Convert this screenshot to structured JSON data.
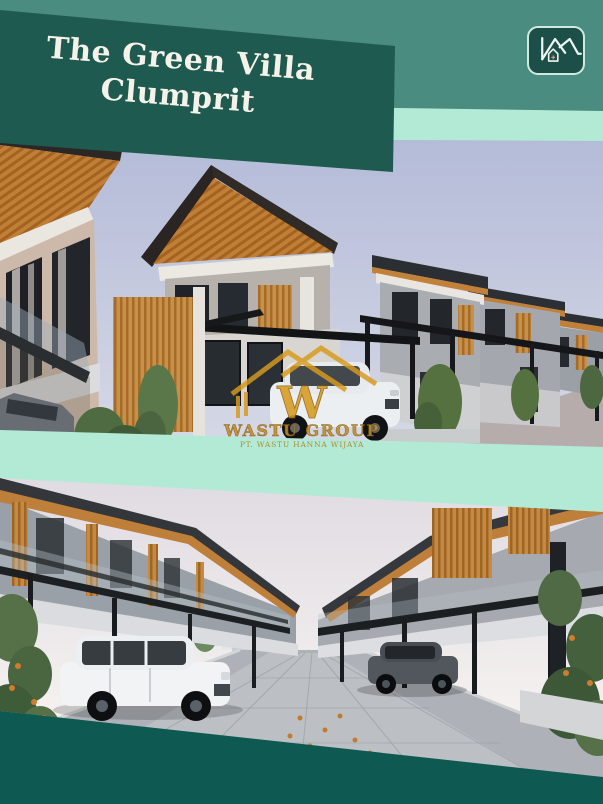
{
  "poster": {
    "banner": {
      "title_line1": "The Green Villa",
      "title_line2": "Clumprit"
    },
    "brand_logo": {
      "icon": "house-roofline-icon"
    },
    "watermark": {
      "logo_letter": "W",
      "brand": "WASTU GROUP",
      "company": "PT. WASTU HANNA WIJAYA"
    },
    "photos": [
      {
        "alt": "Exterior render of a row of modern two-storey villas with dark roofs, orange timber slat accents, black carport pergolas and a white SUV"
      },
      {
        "alt": "Street-level render between two rows of villas with glass carports, a parked white SUV, a grey SUV and a paved road"
      }
    ],
    "colors": {
      "background_teal": "#4A8C7F",
      "banner_teal": "#1F5A50",
      "mint_accent": "#B2EAD5",
      "footer_teal": "#0E5A52",
      "logo_badge_fill": "#1D4F49",
      "logo_border": "#CFE9DF",
      "watermark_gold": "#D79A1F"
    }
  }
}
